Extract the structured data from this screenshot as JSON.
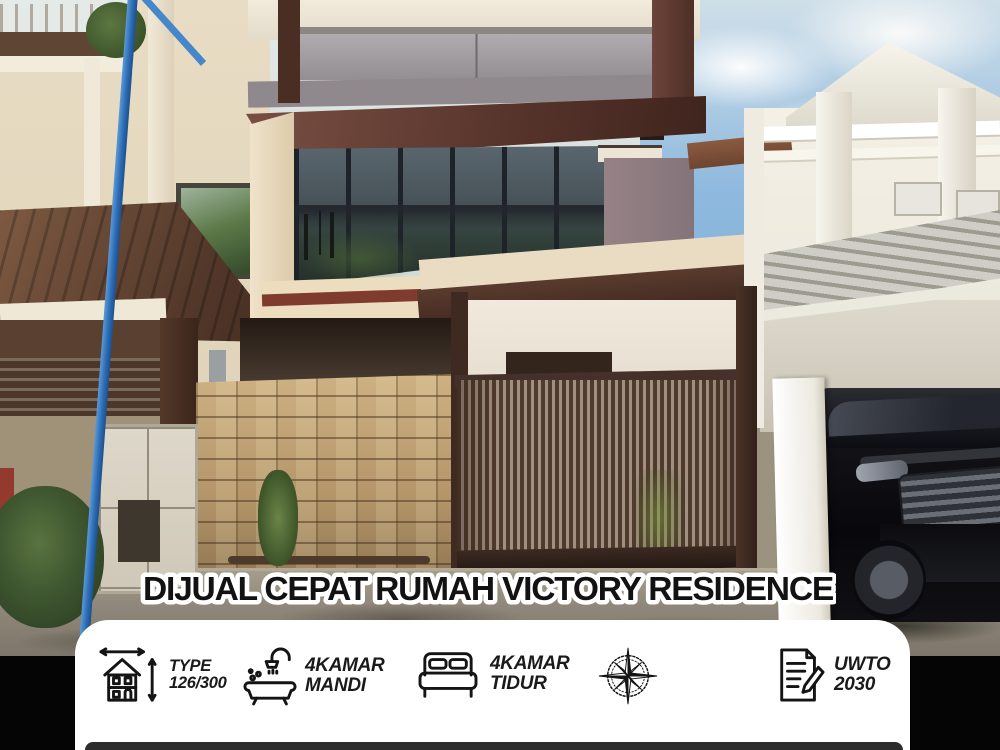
{
  "poster": {
    "title": "DIJUAL CEPAT RUMAH VICTORY RESIDENCE",
    "photo_description": "Street view of a three-storey modern house with glass facade, natural stone fence and brown slatted gate, flanked by neighbouring houses and a parked black SUV",
    "info_items": [
      {
        "icon": "house-dimensions-icon",
        "line1": "TYPE",
        "line2": "126/300"
      },
      {
        "icon": "shower-bathtub-icon",
        "line1": "4KAMAR",
        "line2": "MANDI"
      },
      {
        "icon": "bed-icon",
        "line1": "4KAMAR",
        "line2": "TIDUR"
      },
      {
        "icon": "compass-icon",
        "line1": "",
        "line2": ""
      },
      {
        "icon": "document-pen-icon",
        "line1": "UWTO",
        "line2": "2030"
      }
    ],
    "colors": {
      "card_bg": "#ffffff",
      "bottom_bar": "#2d2d2d",
      "title_fill": "#121212",
      "title_outline": "#ffffff",
      "info_text": "#1a1a1a"
    }
  }
}
